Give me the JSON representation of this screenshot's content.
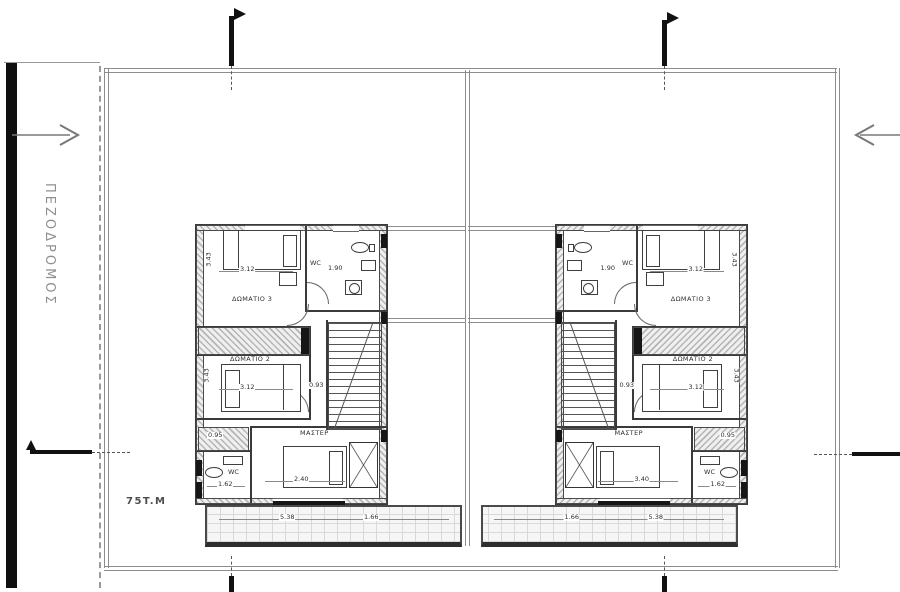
{
  "canvas": {
    "width": 900,
    "height": 592,
    "background": "#ffffff"
  },
  "street": {
    "label": "ΠΕΖΟΔΡΟΜΟΣ"
  },
  "site": {
    "area_label": "75T.M"
  },
  "rooms": {
    "room3": "ΔΩΜΑΤΙΟ 3",
    "room2": "ΔΩΜΑΤΙΟ 2",
    "master": "ΜΑΣΤΕΡ",
    "wc": "WC"
  },
  "plans": {
    "left": {
      "name": "left-house-first-floor",
      "dims": {
        "room3_width": "3.12",
        "room3_depth": "3.43",
        "wc_width": "1.90",
        "room2_width": "3.12",
        "room2_depth": "3.43",
        "stair_width": "0.93",
        "closet_depth": "0.95",
        "wc2_width": "1.62",
        "master_width": "2.40",
        "terrace_width": "5.38",
        "terrace_side": "1.66"
      }
    },
    "right": {
      "name": "right-house-first-floor",
      "dims": {
        "room3_width": "3.12",
        "room3_depth": "3.43",
        "wc_width": "1.90",
        "room2_width": "3.12",
        "room2_depth": "3.43",
        "stair_width": "0.93",
        "closet_depth": "0.95",
        "wc2_width": "1.62",
        "master_width": "3.40",
        "terrace_width": "5.38",
        "terrace_side": "1.66"
      }
    }
  },
  "colors": {
    "wall": "#3a3a3a",
    "boundary": "#8d8d8d",
    "marker": "#111111",
    "street_text": "#8f8f8f"
  }
}
